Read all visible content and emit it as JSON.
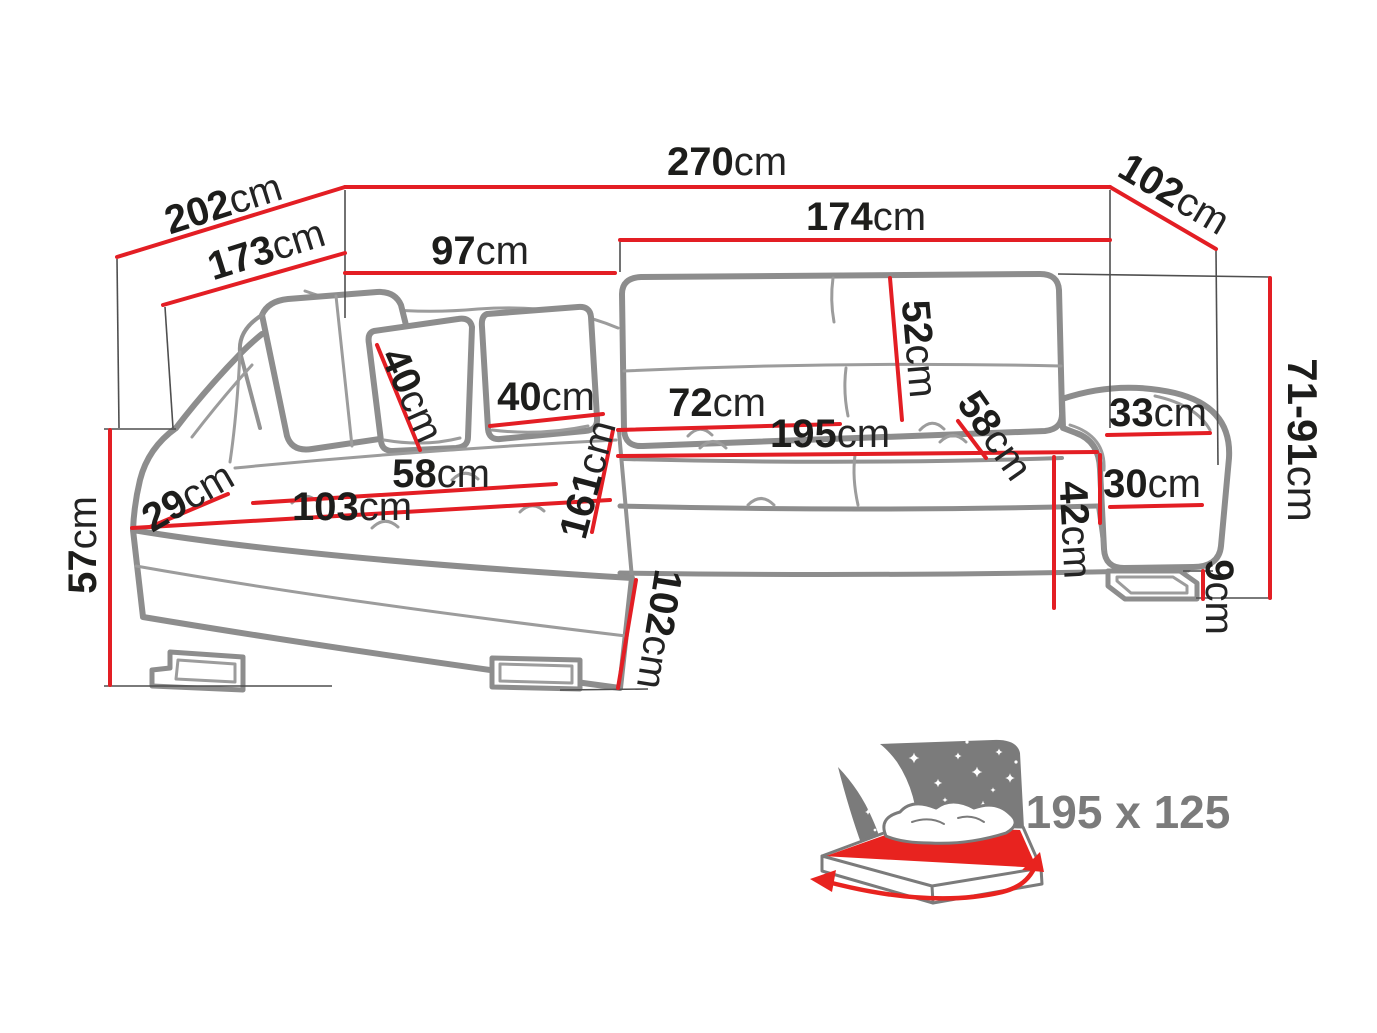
{
  "diagram": {
    "type": "corner-sofa-dimension-drawing",
    "unit": "cm",
    "colors": {
      "dimension_red": "#e31e24",
      "label_black": "#1d1d1b",
      "sofa_outline_gray": "#8d8d8d",
      "icon_gray": "#7b7b7b",
      "bed_mattress_red": "#e8231f"
    },
    "dims": {
      "total_width": {
        "v": "270",
        "u": "cm"
      },
      "back_diagonal": {
        "v": "202",
        "u": "cm"
      },
      "chaise_back_width": {
        "v": "173",
        "u": "cm"
      },
      "chaise_width": {
        "v": "97",
        "u": "cm"
      },
      "seat_front_width": {
        "v": "174",
        "u": "cm"
      },
      "side_depth": {
        "v": "102",
        "u": "cm"
      },
      "backrest_height": {
        "v": "52",
        "u": "cm"
      },
      "pillow_side": {
        "v": "40",
        "u": "cm"
      },
      "pillow_front": {
        "v": "40",
        "u": "cm"
      },
      "seat_section_width": {
        "v": "72",
        "u": "cm"
      },
      "seat_total_width": {
        "v": "195",
        "u": "cm"
      },
      "seat_depth": {
        "v": "58",
        "u": "cm"
      },
      "armrest_top_width": {
        "v": "33",
        "u": "cm"
      },
      "armrest_width": {
        "v": "30",
        "u": "cm"
      },
      "seat_front_height": {
        "v": "42",
        "u": "cm"
      },
      "leg_height": {
        "v": "9",
        "u": "cm"
      },
      "total_height": {
        "v": "71-91",
        "u": "cm"
      },
      "chaise_arm_depth": {
        "v": "29",
        "u": "cm"
      },
      "chaise_seat_depth": {
        "v": "58",
        "u": "cm"
      },
      "chaise_seat_length": {
        "v": "103",
        "u": "cm"
      },
      "chaise_length": {
        "v": "161",
        "u": "cm"
      },
      "arm_height": {
        "v": "57",
        "u": "cm"
      },
      "chaise_front_depth": {
        "v": "102",
        "u": "cm"
      }
    },
    "sleeping_area": {
      "size": "195 x 125"
    }
  }
}
